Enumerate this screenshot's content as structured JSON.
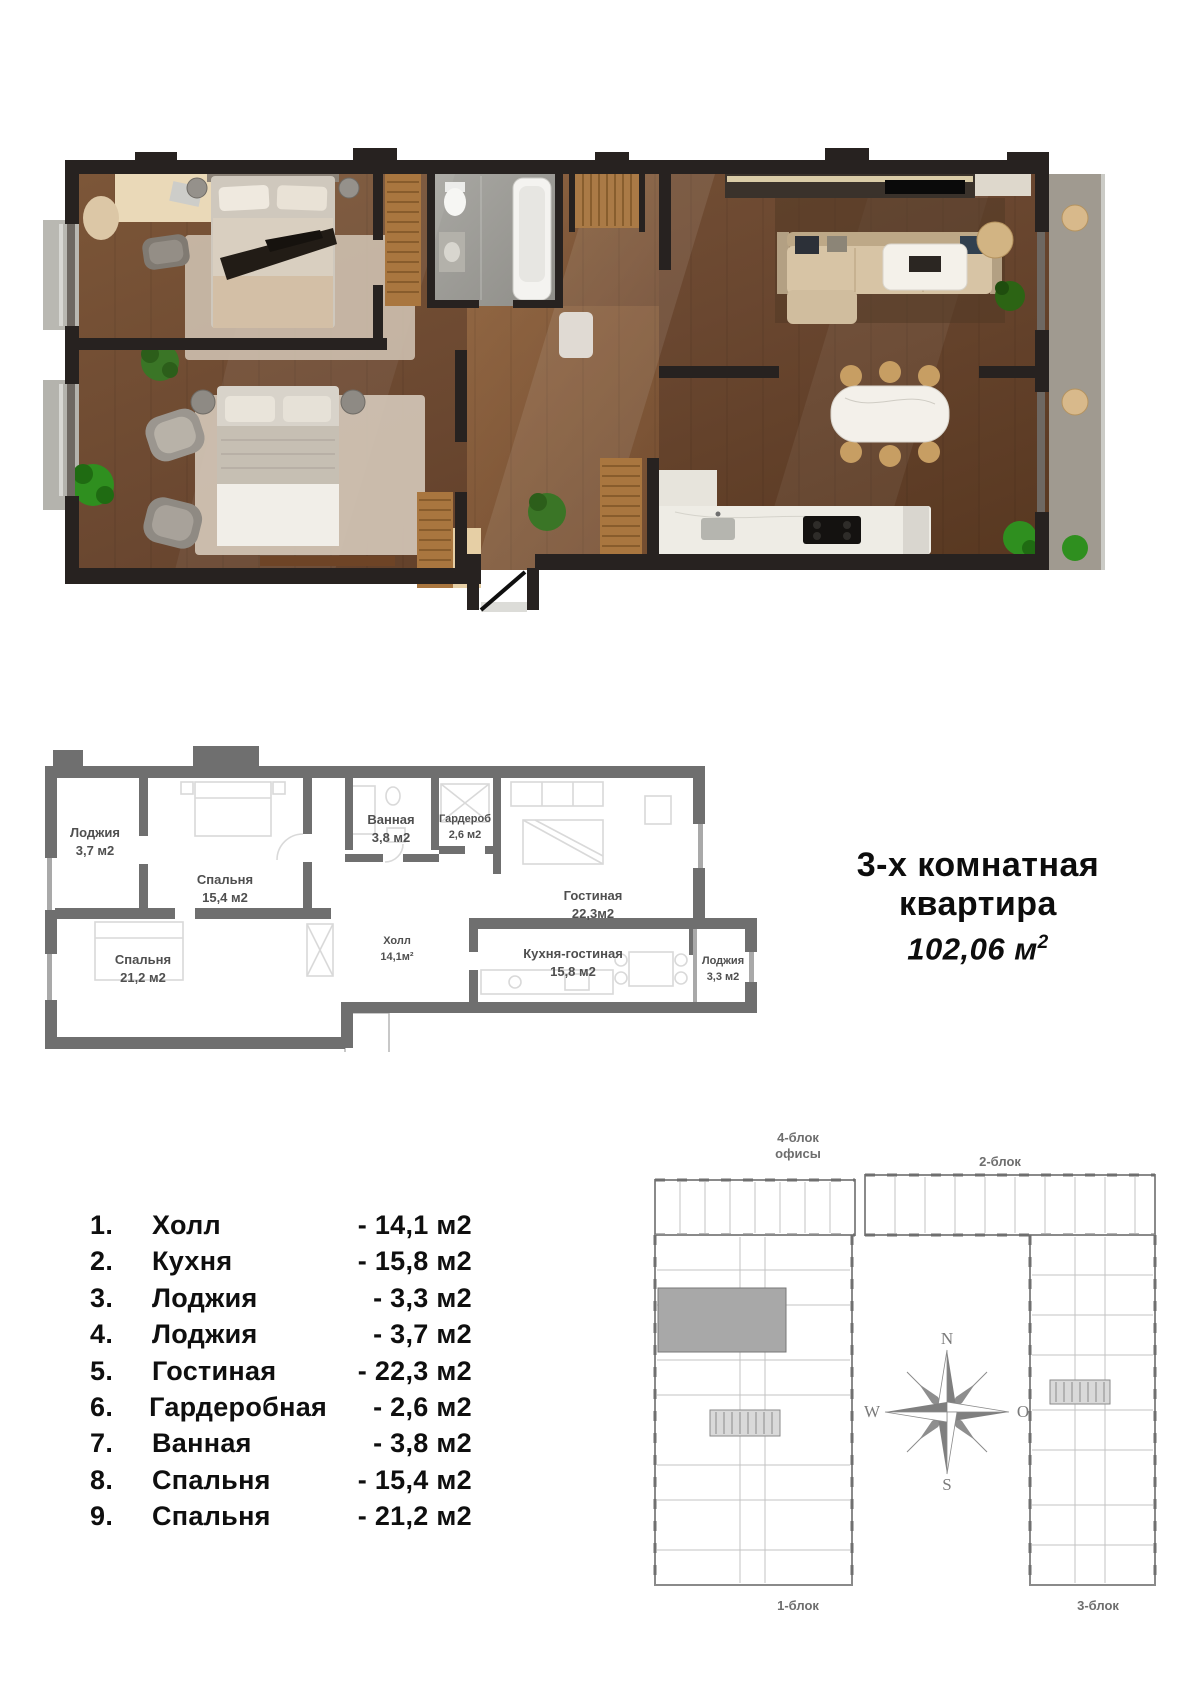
{
  "apartment": {
    "type_line1": "3-х комнатная",
    "type_line2": "квартира",
    "total_area": "102,06 м",
    "total_area_sup": "2"
  },
  "plan2d": {
    "rooms": [
      {
        "name": "Лоджия",
        "area": "3,7 м2"
      },
      {
        "name": "Спальня",
        "area": "15,4 м2"
      },
      {
        "name": "Спальня",
        "area": "21,2 м2"
      },
      {
        "name": "Ванная",
        "area": "3,8 м2"
      },
      {
        "name": "Гардероб",
        "area": "2,6 м2"
      },
      {
        "name": "Холл",
        "area": "14,1м²"
      },
      {
        "name": "Гостиная",
        "area": "22,3м2"
      },
      {
        "name": "Кухня-гостиная",
        "area": "15,8 м2"
      },
      {
        "name": "Лоджия",
        "area": "3,3 м2"
      }
    ]
  },
  "legend": {
    "items": [
      {
        "num": "1.",
        "name": "Холл",
        "value": "- 14,1 м2"
      },
      {
        "num": "2.",
        "name": "Кухня",
        "value": "- 15,8 м2"
      },
      {
        "num": "3.",
        "name": "Лоджия",
        "value": "- 3,3 м2"
      },
      {
        "num": "4.",
        "name": "Лоджия",
        "value": "- 3,7 м2"
      },
      {
        "num": "5.",
        "name": "Гостиная",
        "value": "- 22,3 м2"
      },
      {
        "num": "6.",
        "name": "Гардеробная",
        "value": "- 2,6 м2"
      },
      {
        "num": "7.",
        "name": "Ванная",
        "value": "- 3,8 м2"
      },
      {
        "num": "8.",
        "name": "Спальня",
        "value": "- 15,4 м2"
      },
      {
        "num": "9.",
        "name": "Спальня",
        "value": "- 21,2 м2"
      }
    ]
  },
  "site_plan": {
    "block4_line1": "4-блок",
    "block4_line2": "офисы",
    "block2": "2-блок",
    "block1": "1-блок",
    "block3": "3-блок",
    "compass": {
      "n": "N",
      "w": "W",
      "o": "O",
      "s": "S"
    }
  },
  "colors": {
    "walls_3d": "#272220",
    "wood_floor": "#6f4b31",
    "walls_2d": "#6f6f6f",
    "text": "#0f0f0f",
    "site_gray": "#8a8a8a"
  }
}
